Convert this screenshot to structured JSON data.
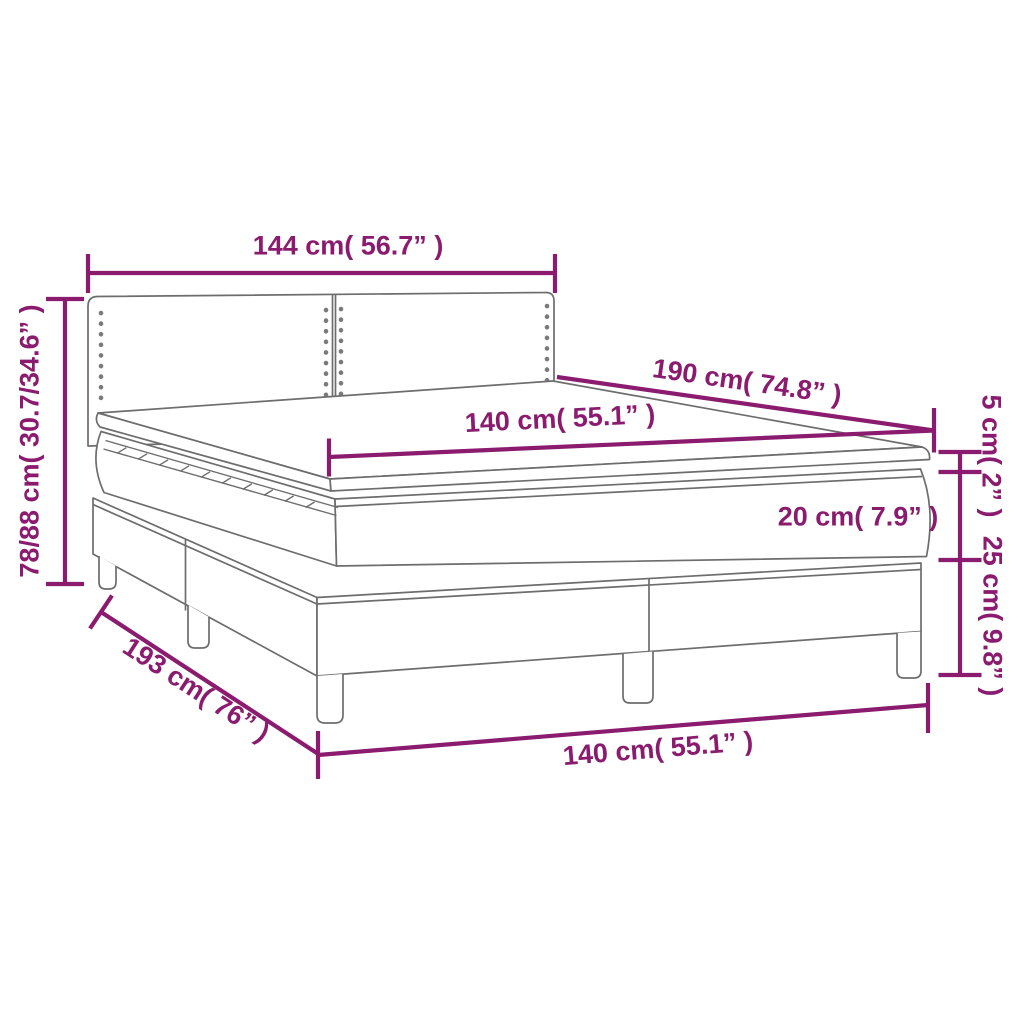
{
  "title": "Box spring bed with mattress and topper — dimension diagram",
  "diagram": {
    "accent_color": "#8a1b6e",
    "line_color": "#6d6d6d",
    "background_color": "#ffffff",
    "labels": {
      "headboard_width": "144 cm( 56.7” )",
      "headboard_height": "78/88 cm( 30.7/34.6” )",
      "bed_length": "190 cm( 74.8” )",
      "mattress_width": "140 cm( 55.1” )",
      "topper_thickness": "5 cm( 2” )",
      "mattress_thickness": "20 cm( 7.9” )",
      "base_height": "25 cm( 9.8” )",
      "base_length": "193 cm( 76” )",
      "base_width": "140 cm( 55.1” )"
    }
  }
}
